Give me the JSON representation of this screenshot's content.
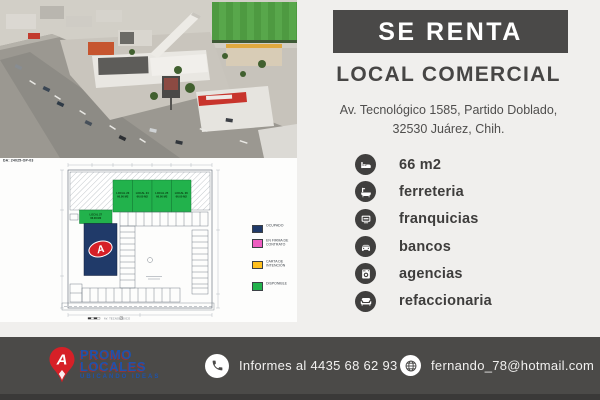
{
  "banner": {
    "label": "SE RENTA"
  },
  "listing": {
    "title": "LOCAL COMERCIAL",
    "address_line1": "Av. Tecnológico 1585, Partido Doblado,",
    "address_line2": "32530 Juárez, Chih."
  },
  "features": {
    "items": [
      {
        "icon": "bed-icon",
        "label": "66 m2"
      },
      {
        "icon": "bathtub-icon",
        "label": "ferreteria"
      },
      {
        "icon": "tv-icon",
        "label": "franquicias"
      },
      {
        "icon": "car-icon",
        "label": "bancos"
      },
      {
        "icon": "washer-icon",
        "label": "agencias"
      },
      {
        "icon": "sofa-icon",
        "label": "refaccionaria"
      }
    ]
  },
  "site_plan": {
    "doc_ref": "DA: 24025-OP-03",
    "street_caption": "AV. TECNOLÓGICO",
    "occupied_unit": {
      "brand_letter": "A"
    },
    "available_units": [
      {
        "name": "LOCAL 23",
        "area": "66.00 M2"
      },
      {
        "name": "LOCAL 24",
        "area": "66.00 M2"
      },
      {
        "name": "LOCAL 25",
        "area": "66.00 M2"
      },
      {
        "name": "LOCAL 26",
        "area": "66.00 M2"
      },
      {
        "name": "LOCAL 27",
        "area": "66.00 M2"
      }
    ],
    "legend": [
      {
        "color": "#203a69",
        "label": "OCUPADO"
      },
      {
        "color": "#ee5ec1",
        "label": "EN FIRMA DE CONTRATO"
      },
      {
        "color": "#ffc01e",
        "label": "CARTA DE INTENCIÓN"
      },
      {
        "color": "#22b24c",
        "label": "DISPONIBLE"
      }
    ]
  },
  "footer": {
    "brand": {
      "pin_letter": "A",
      "name_line1": "PROMO",
      "name_line2": "LOCALES",
      "tagline": "UBICANDO IDEAS"
    },
    "phone": {
      "icon": "phone-icon",
      "label": "Informes al 4435 68 62 93"
    },
    "email": {
      "icon": "globe-icon",
      "label": "fernando_78@hotmail.com"
    }
  },
  "colors": {
    "panel_bg": "#f0efed",
    "banner_bg": "#4a4948",
    "footer_bg": "#4b4a48",
    "badge_bg": "#403f3e",
    "brand_blue": "#1d53ac",
    "brand_red": "#d62027",
    "available_green": "#22b24c",
    "occupied_navy": "#203a69"
  }
}
